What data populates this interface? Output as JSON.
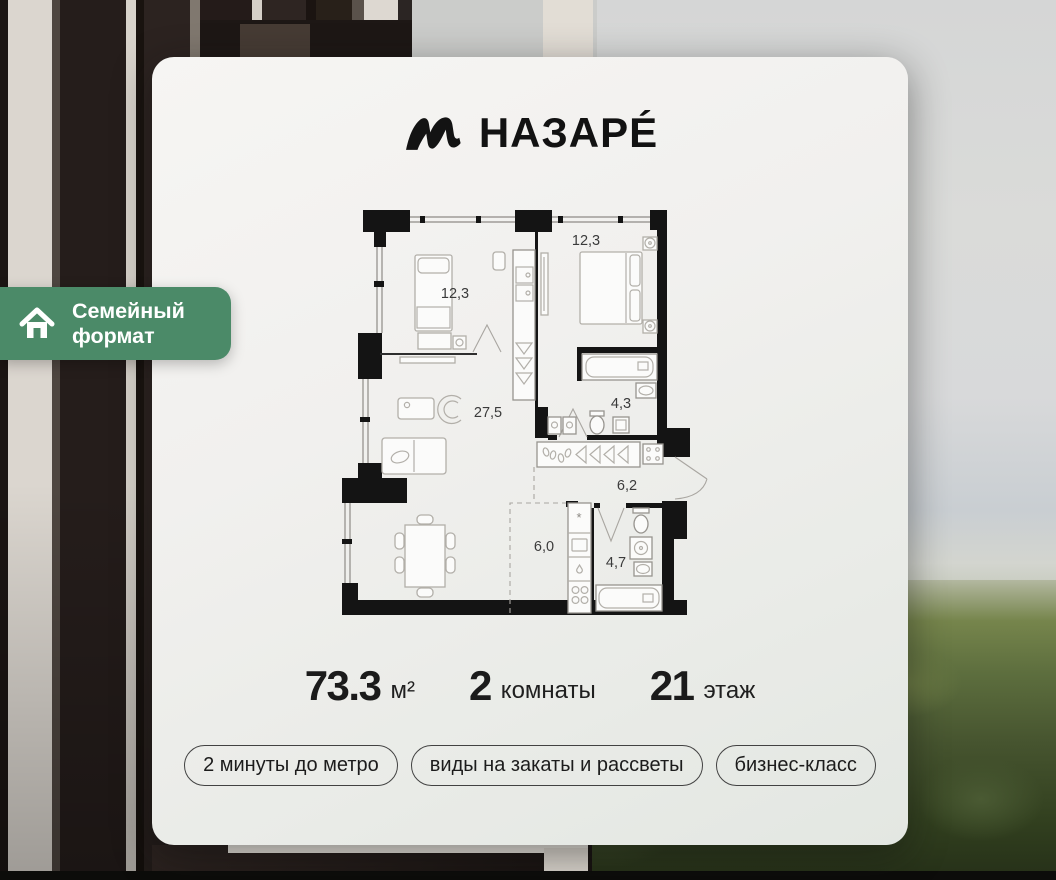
{
  "brand": {
    "name": "НАЗАРÉ"
  },
  "family_badge": {
    "line1": "Семейный",
    "line2": "формат",
    "color": "#4b8a68"
  },
  "floor_plan": {
    "rooms": [
      {
        "id": "bedroom-1",
        "area_label": "12,3"
      },
      {
        "id": "bedroom-2",
        "area_label": "12,3"
      },
      {
        "id": "living-room",
        "area_label": "27,5"
      },
      {
        "id": "bathroom-1",
        "area_label": "4,3"
      },
      {
        "id": "hallway",
        "area_label": "6,2"
      },
      {
        "id": "kitchen",
        "area_label": "6,0"
      },
      {
        "id": "bathroom-2",
        "area_label": "4,7"
      }
    ]
  },
  "stats": {
    "area": {
      "value": "73.3",
      "unit": "м²"
    },
    "rooms": {
      "value": "2",
      "unit": "комнаты"
    },
    "floor": {
      "value": "21",
      "unit": "этаж"
    }
  },
  "tags": [
    "2 минуты до метро",
    "виды на закаты и рассветы",
    "бизнес-класс"
  ],
  "colors": {
    "card_bg": "#f1f0ee",
    "accent_green": "#4b8a68",
    "wall_black": "#141414"
  }
}
